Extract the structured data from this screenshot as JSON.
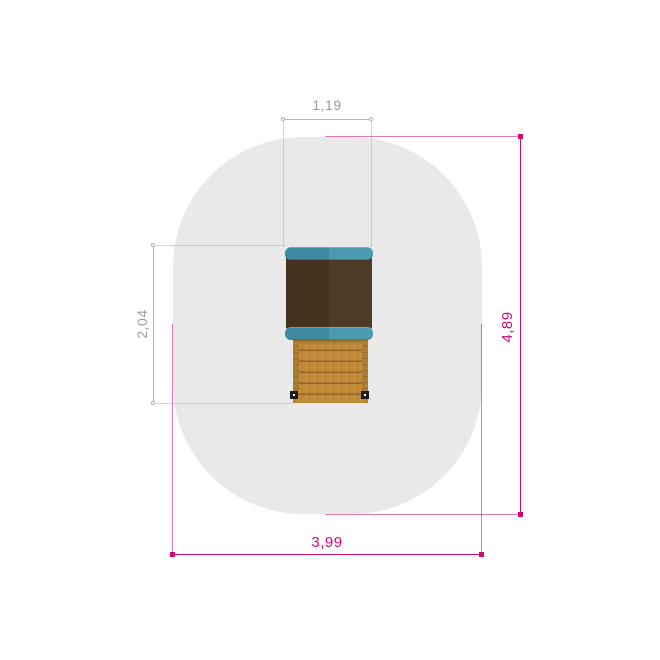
{
  "drawing": {
    "type": "playground-equipment-plan-view",
    "dimensions": {
      "roof_width": {
        "value": "1,19",
        "unit": "m"
      },
      "structure_depth": {
        "value": "2,04",
        "unit": "m"
      },
      "zone_length": {
        "value": "4,89",
        "unit": "m"
      },
      "zone_width": {
        "value": "3,99",
        "unit": "m"
      }
    },
    "colors": {
      "zone": "#e9e9e9",
      "dim_gray": "#b3b3b3",
      "dim_gray_text": "#9b9b9b",
      "dim_magenta": "#d10a70",
      "roof_left": "#44331e",
      "roof_right": "#4d3b25",
      "teal_left": "#3e8ba1",
      "teal_right": "#4b9aaf",
      "wood": "#c28c3a",
      "wood_rail": "#b07c2e",
      "post": "#1c1c1c"
    }
  }
}
